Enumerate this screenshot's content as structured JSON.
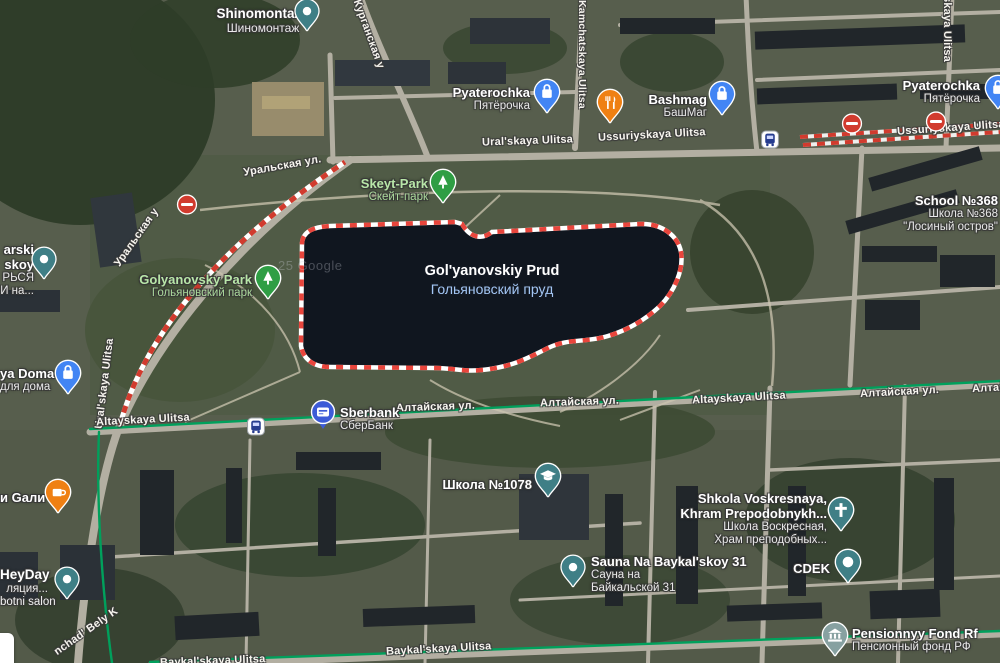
{
  "attribution": "25 Google",
  "water": {
    "en": "Gol'yanovskiy Prud",
    "ru": "Гольяновский пруд"
  },
  "pois": {
    "shinomontazh": {
      "en": "Shinomontazh",
      "ru": "Шиномонтаж"
    },
    "pyaterochka": {
      "en": "Pyaterochka",
      "ru": "Пятёрочка"
    },
    "bashmag": {
      "en": "Bashmag",
      "ru": "БашМаг"
    },
    "school368": {
      "en": "School №368",
      "ru": "Школа №368",
      "ru2": "\"Лосиный остров\""
    },
    "skeyt_park": {
      "en": "Skeyt-Park",
      "ru": "Скейт-парк"
    },
    "golyanovsky_park": {
      "en": "Golyanovsky Park",
      "ru": "Гольяновский парк"
    },
    "left_truncated": {
      "l1": "arski",
      "l2": "skoy",
      "l3": "РЬСЯ",
      "l4": "И на..."
    },
    "dlya_doma": {
      "en": "ya Doma",
      "ru": "для дома"
    },
    "gali": {
      "label": "и Gали"
    },
    "heyday": {
      "l1": "HeyDay",
      "l2": "ляция...",
      "l3": "botni salon"
    },
    "sberbank": {
      "en": "Sberbank",
      "ru": "СберБанк"
    },
    "shkola1078": {
      "ru": "Школа №1078"
    },
    "sauna": {
      "en": "Sauna Na Baykal'skoy 31",
      "ru1": "Сауна на",
      "ru2": "Байкальской 31"
    },
    "voskresnaya": {
      "en1": "Shkola Voskresnaya,",
      "en2": "Khram Prepodobnykh...",
      "ru1": "Школа Воскресная,",
      "ru2": "Храм преподобных..."
    },
    "cdek": {
      "label": "CDEK"
    },
    "pension": {
      "en": "Pensionnyy Fond Rf",
      "ru": "Пенсионный фонд РФ"
    }
  },
  "streets": {
    "kurganskaya": "Курганская у",
    "kamchatskaya": "Kamchatskaya Ulitsa",
    "uralskaya_en": "Ural'skaya Ulitsa",
    "uralskaya_ru": "Уральская ул.",
    "uralskaya_ru_short": "Уральская у",
    "ussuriyskaya_en": "Ussuriyskaya Ulitsa",
    "altayskaya_en": "Altayskaya Ulitsa",
    "altayskaya_ru": "Алтайская ул.",
    "baykalskaya_en": "Baykal'skaya Ulitsa",
    "top_right_vertical": "skaya Ulitsa",
    "bely": "nchad' Bely K"
  },
  "colors": {
    "pond_fill": "#10161f",
    "selection_red": "#e8453c",
    "transit_green": "#00a05c",
    "poi_blue": "#4285f4",
    "poi_teal": "#3f7f86",
    "poi_green": "#2f9e44",
    "poi_orange": "#ef8013",
    "no_entry_red": "#d13b2e",
    "sberbank_blue": "#3d5bd7"
  }
}
